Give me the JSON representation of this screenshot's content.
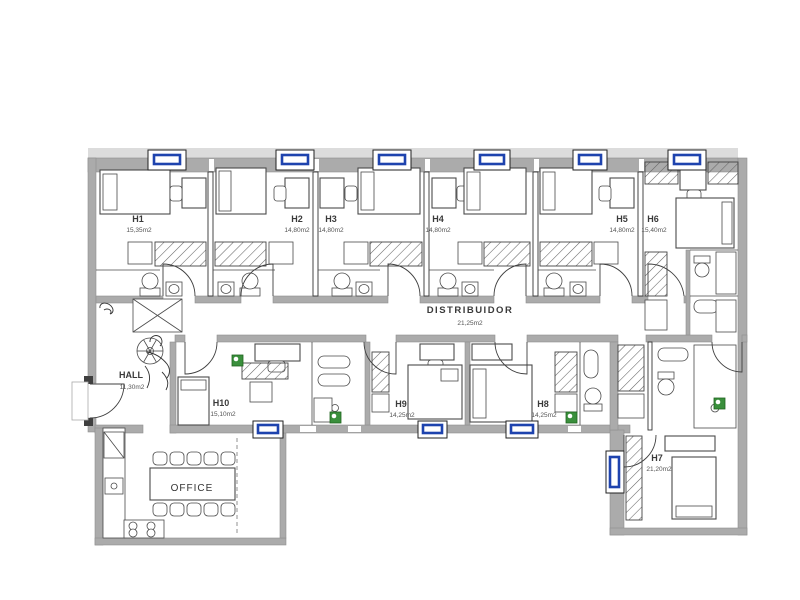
{
  "rooms": {
    "h1": {
      "name": "H1",
      "area": "15,35m2"
    },
    "h2": {
      "name": "H2",
      "area": "14,80m2"
    },
    "h3": {
      "name": "H3",
      "area": "14,80m2"
    },
    "h4": {
      "name": "H4",
      "area": "14,80m2"
    },
    "h5": {
      "name": "H5",
      "area": "14,80m2"
    },
    "h6": {
      "name": "H6",
      "area": "15,40m2"
    },
    "h7": {
      "name": "H7",
      "area": "21,20m2"
    },
    "h8": {
      "name": "H8",
      "area": "14,25m2"
    },
    "h9": {
      "name": "H9",
      "area": "14,25m2"
    },
    "h10": {
      "name": "H10",
      "area": "15,10m2"
    },
    "distribuidor": {
      "name": "DISTRIBUIDOR",
      "area": "21,25m2"
    },
    "hall": {
      "name": "HALL",
      "area": "11,30m2"
    },
    "office": {
      "name": "OFFICE"
    }
  },
  "colors": {
    "wall": "#ababab",
    "window_blue": "#1e43ae",
    "radiator_green": "#3a8f3c",
    "drawing_line": "#4a4a4a",
    "background": "#ffffff"
  }
}
